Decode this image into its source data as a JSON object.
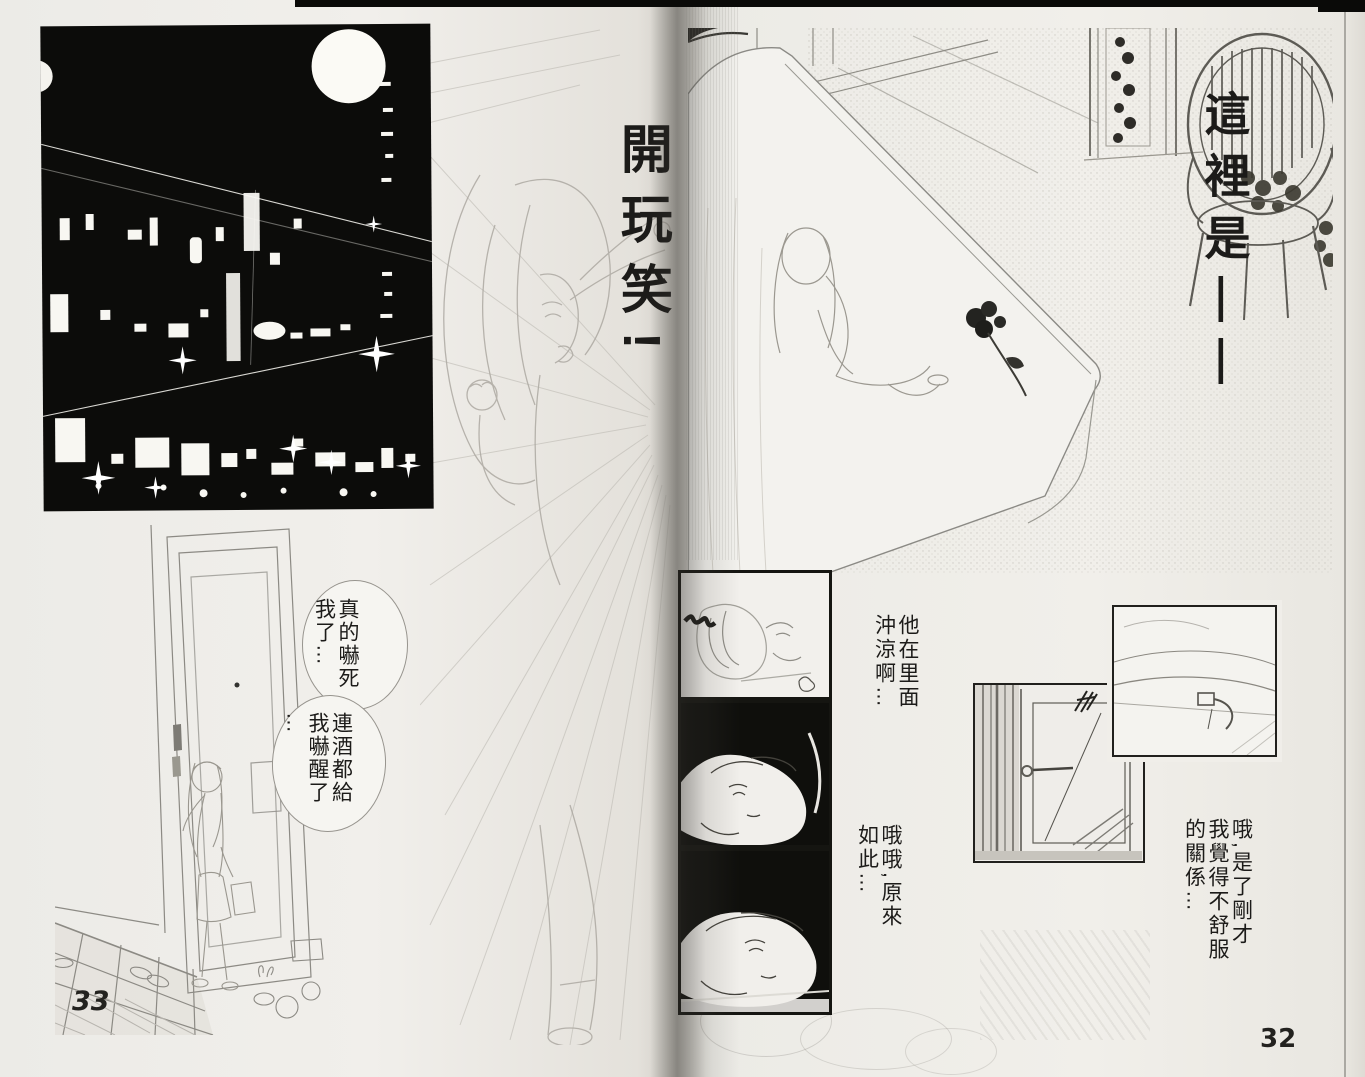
{
  "book": {
    "left_page_number": "33",
    "right_page_number": "32"
  },
  "left_page": {
    "sfx_exclaim": "開玩笑!",
    "bubble_scared_cols": [
      "真的嚇死",
      "我了…"
    ],
    "bubble_sober_cols": [
      "連酒都給",
      "我嚇醒了",
      "…"
    ]
  },
  "right_page": {
    "caption_location": "這裡是——",
    "thought_shower_cols": [
      "他在里面",
      "沖涼啊…"
    ],
    "thought_realize_cols": [
      "哦哦,原來",
      "如此…"
    ],
    "thought_reason_cols": [
      "哦,是了剛才",
      "我覺得不舒服",
      "的關係…"
    ]
  }
}
